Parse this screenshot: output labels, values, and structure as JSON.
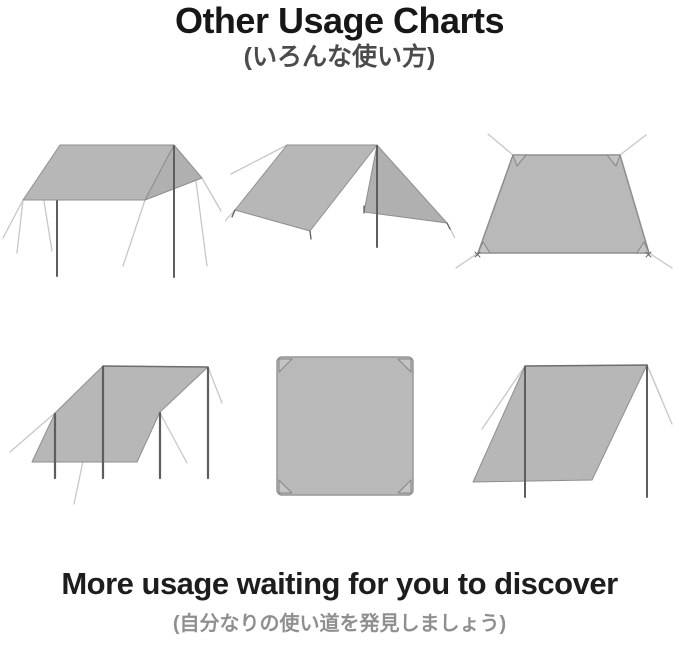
{
  "header": {
    "title": "Other Usage Charts",
    "subtitle_jp": "(いろんな使い方)"
  },
  "footer": {
    "title": "More usage waiting for you to discover",
    "subtitle_jp": "(自分なりの使い道を発見しましょう)"
  },
  "diagrams": [
    {
      "name": "flat-canopy-on-two-poles"
    },
    {
      "name": "a-frame-tarp-shelter"
    },
    {
      "name": "staked-ground-sheet"
    },
    {
      "name": "multi-pole-awning-lean-to"
    },
    {
      "name": "flat-square-tarp-top-view"
    },
    {
      "name": "lean-to-shelter-two-poles"
    }
  ],
  "colors": {
    "background": "#ffffff",
    "tarp_fill": "#b7b7b7",
    "tarp_outline": "#8e8e8e",
    "pole": "#5e5e5e",
    "guy_line": "#c7c7c7",
    "title_text": "#171717",
    "subtitle_text": "#4b4b4b",
    "footer_text": "#1d1d1d",
    "footer_subtitle_text": "#8f8f8f"
  }
}
